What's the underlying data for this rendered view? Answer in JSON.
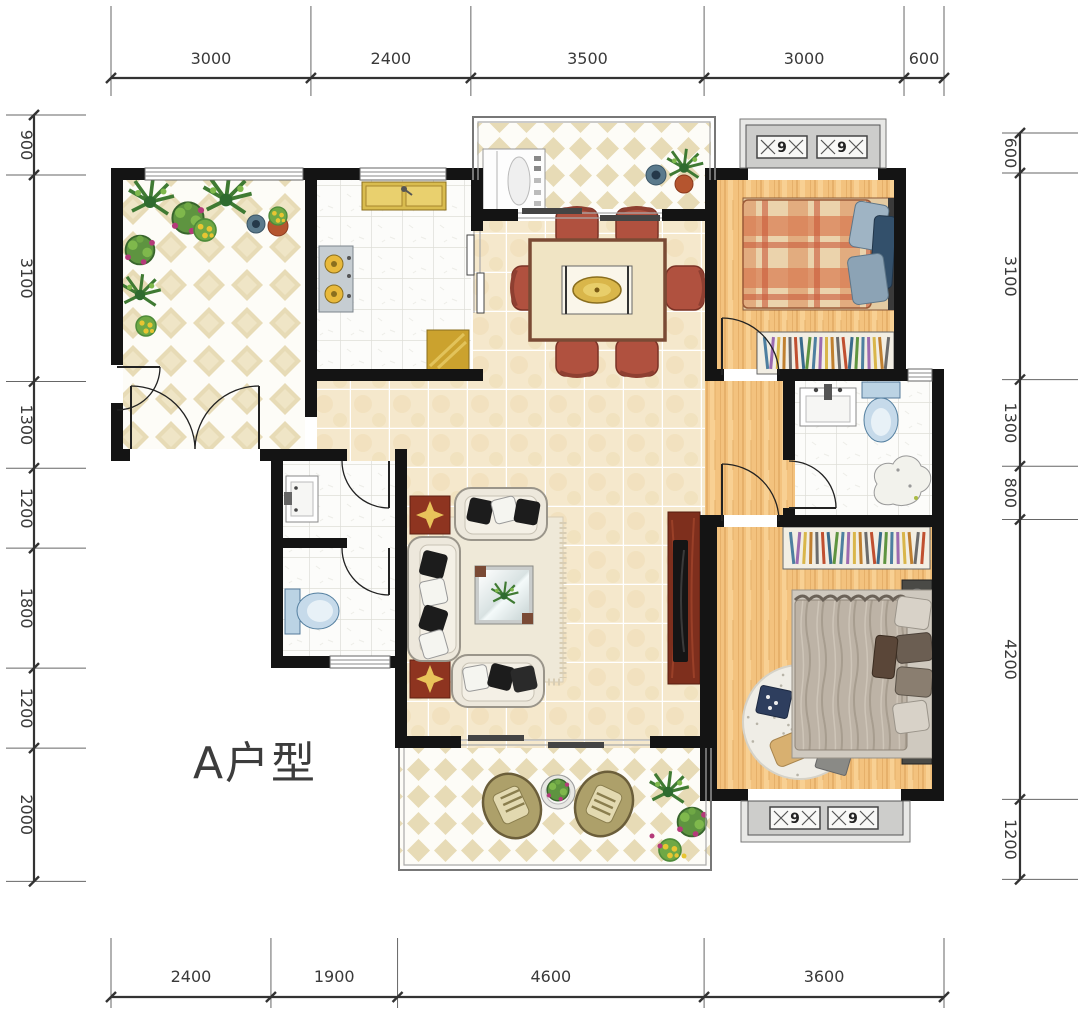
{
  "title": {
    "label": "A户型"
  },
  "dimensions": {
    "top": [
      "3000",
      "2400",
      "3500",
      "3000",
      "600"
    ],
    "bottom": [
      "2400",
      "1900",
      "4600",
      "3600"
    ],
    "left": [
      "900",
      "3100",
      "1300",
      "1200",
      "1800",
      "1200",
      "2000"
    ],
    "right": [
      "600",
      "3100",
      "1300",
      "800",
      "4200",
      "1200"
    ]
  },
  "bay_window_glyph": "9",
  "colors": {
    "wall": "#141414",
    "wood_floor": "#F3C27E",
    "beige_tile": "#F5E8CC",
    "diamond_tile": "#E7DBB6",
    "white_tile": "#FCFCFA",
    "bay_fill": "#CDCDCB",
    "chair_red": "#B0513F",
    "cabinet_red": "#7E2F1D",
    "gold": "#D9B64A",
    "toilet_blue": "#C6DAEA",
    "sofa_cream": "#EDE8DC",
    "plant_green": "#5E9440"
  }
}
